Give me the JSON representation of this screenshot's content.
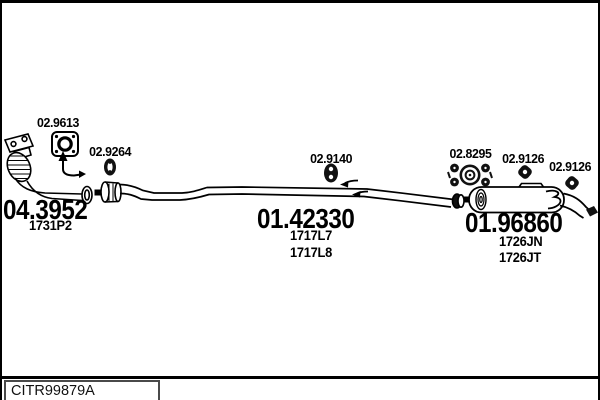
{
  "page": {
    "footer_code": "CITR99879A"
  },
  "diagram": {
    "colors": {
      "line": "#000000",
      "background": "#ffffff"
    },
    "component_labels": [
      {
        "id": "flange-gasket",
        "label": "02.9613"
      },
      {
        "id": "front-clamp",
        "label": "02.9264"
      },
      {
        "id": "centre-hanger",
        "label": "02.9140"
      },
      {
        "id": "rear-mount",
        "label": "02.8295"
      },
      {
        "id": "rear-hanger-1",
        "label": "02.9126"
      },
      {
        "id": "rear-hanger-2",
        "label": "02.9126"
      }
    ],
    "assemblies": [
      {
        "id": "catalytic-converter",
        "part_number": "04.3952",
        "alt_numbers": [
          "1731P2"
        ]
      },
      {
        "id": "centre-pipe",
        "part_number": "01.42330",
        "alt_numbers": [
          "1717L7",
          "1717L8"
        ]
      },
      {
        "id": "rear-silencer",
        "part_number": "01.96860",
        "alt_numbers": [
          "1726JN",
          "1726JT"
        ]
      }
    ]
  }
}
